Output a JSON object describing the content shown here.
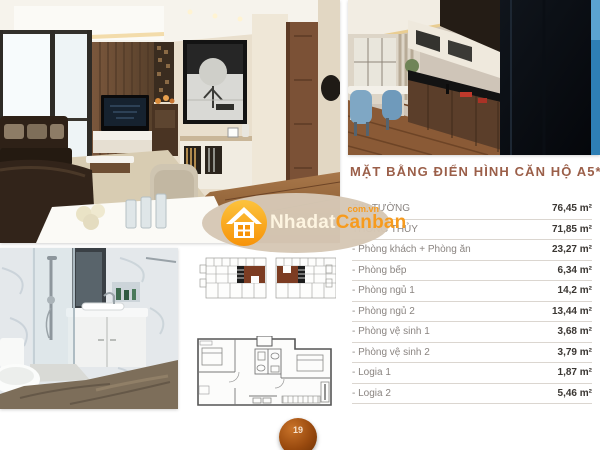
{
  "page": {
    "number": "19"
  },
  "plan": {
    "title": "MẶT BẰNG ĐIỂN HÌNH CĂN HỘ A5*",
    "rows": [
      {
        "label": "TIM TƯỜNG",
        "value": "76,45 m²"
      },
      {
        "label": "THÔNG THỦY",
        "value": "71,85 m²"
      },
      {
        "label": "- Phòng khách + Phòng ăn",
        "value": "23,27 m²"
      },
      {
        "label": "- Phòng bếp",
        "value": "6,34 m²"
      },
      {
        "label": "- Phòng ngủ 1",
        "value": "14,2 m²"
      },
      {
        "label": "- Phòng ngủ 2",
        "value": "13,44 m²"
      },
      {
        "label": "- Phòng vệ sinh 1",
        "value": "3,68 m²"
      },
      {
        "label": "- Phòng vệ sinh 2",
        "value": "3,79 m²"
      },
      {
        "label": "- Logia 1",
        "value": "1,87 m²"
      },
      {
        "label": "- Logia 2",
        "value": "5,46 m²"
      }
    ]
  },
  "watermark": {
    "brand_primary": "Nhadat",
    "brand_secondary": "Canban",
    "domain_suffix": "com.vn"
  },
  "colors": {
    "title_text": "#9b5f49",
    "accent_orange": "#f79b1d",
    "watermark_bg": "#d6c7b5",
    "keyplan_core": "#7c3c22",
    "page_ball": "#98490e"
  }
}
